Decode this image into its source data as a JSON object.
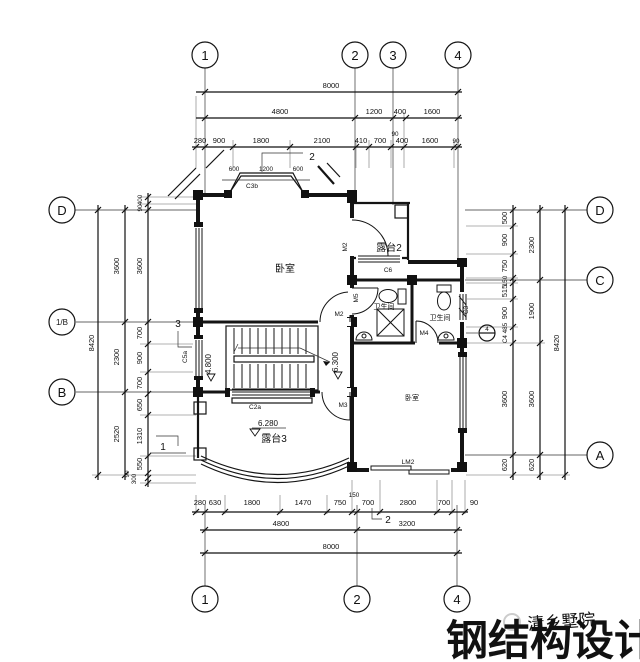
{
  "axes": {
    "top": [
      "1",
      "2",
      "3",
      "4"
    ],
    "bottom": [
      "1",
      "2",
      "4"
    ],
    "left": [
      "D",
      "1/B",
      "B"
    ],
    "right": [
      "D",
      "C",
      "A"
    ]
  },
  "dims": {
    "top_total": "8000",
    "top_row2": [
      "4800",
      "1200",
      "400",
      "1600"
    ],
    "top_row3": [
      "280",
      "900",
      "1800",
      "2100",
      "410",
      "700",
      "90",
      "400",
      "1600",
      "90"
    ],
    "bay": [
      "600",
      "1200",
      "600"
    ],
    "bottom_row1": [
      "280",
      "630",
      "1800",
      "1470",
      "750",
      "150",
      "700",
      "2800",
      "700",
      "90"
    ],
    "bottom_row2": [
      "4800",
      "3200"
    ],
    "bottom_total": "8000",
    "left_outer": "8420",
    "left_mid": [
      "3600",
      "2300",
      "2520"
    ],
    "left_inner": [
      "400",
      "90",
      "3600",
      "700",
      "900",
      "700",
      "650",
      "1310",
      "550",
      "300",
      "90"
    ],
    "right_inner": [
      "500",
      "900",
      "750",
      "150",
      "515",
      "900",
      "C4 485",
      "3600",
      "620"
    ],
    "right_mid": [
      "2300",
      "1900",
      "3600",
      "620"
    ],
    "right_outer": "8420"
  },
  "rooms": {
    "bedroom_top": "卧室",
    "terrace2": "露台2",
    "bath_left": "卫生间",
    "bath_right": "卫生间",
    "bedroom_bottom": "卧室",
    "terrace3": "露台3"
  },
  "levels": {
    "stair_left": "4.800",
    "stair_right": "6.300",
    "terrace3": "6.280"
  },
  "openings": {
    "c3b": "C3b",
    "m2_terrace": "M2",
    "c6": "C6",
    "m5": "M5",
    "m2_bedroom": "M2",
    "m4": "M4",
    "c3": "C3",
    "c5a": "C5a",
    "c2a": "C2a",
    "m3": "M3",
    "lm2": "LM2"
  },
  "markers": {
    "sec2_top": "2",
    "sec3_left": "3",
    "sec1_left": "1",
    "sec2_bottom": "2",
    "detail4": "4"
  },
  "watermark": {
    "big": "钢结构设计",
    "small": "清乡墅院"
  },
  "colors": {
    "watermark_big": "#dadada",
    "watermark_small": "#c3c3c3"
  }
}
